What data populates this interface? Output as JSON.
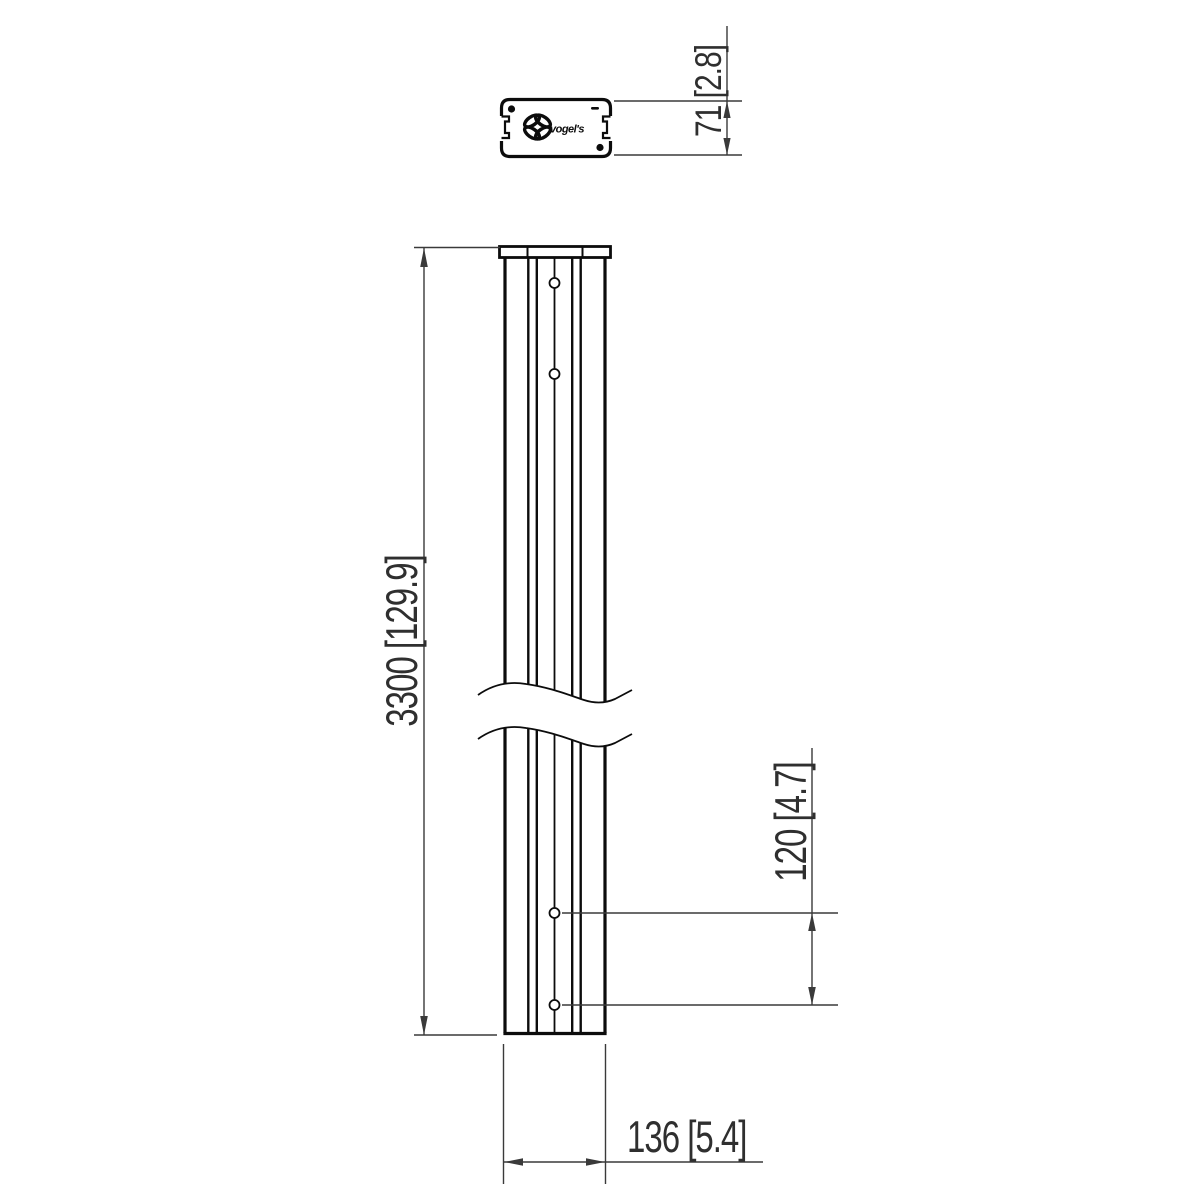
{
  "colors": {
    "paper": "#ffffff",
    "line-heavy": "#0c0c0c",
    "line-dim": "#3a3a3a",
    "text": "#2f2f2f"
  },
  "drawing": {
    "brand": "vogel's",
    "dimensions": {
      "profile_depth": "71 [2.8]",
      "pole_length": "3300 [129.9]",
      "hole_pitch": "120 [4.7]",
      "pole_width": "136 [5.4]"
    }
  }
}
